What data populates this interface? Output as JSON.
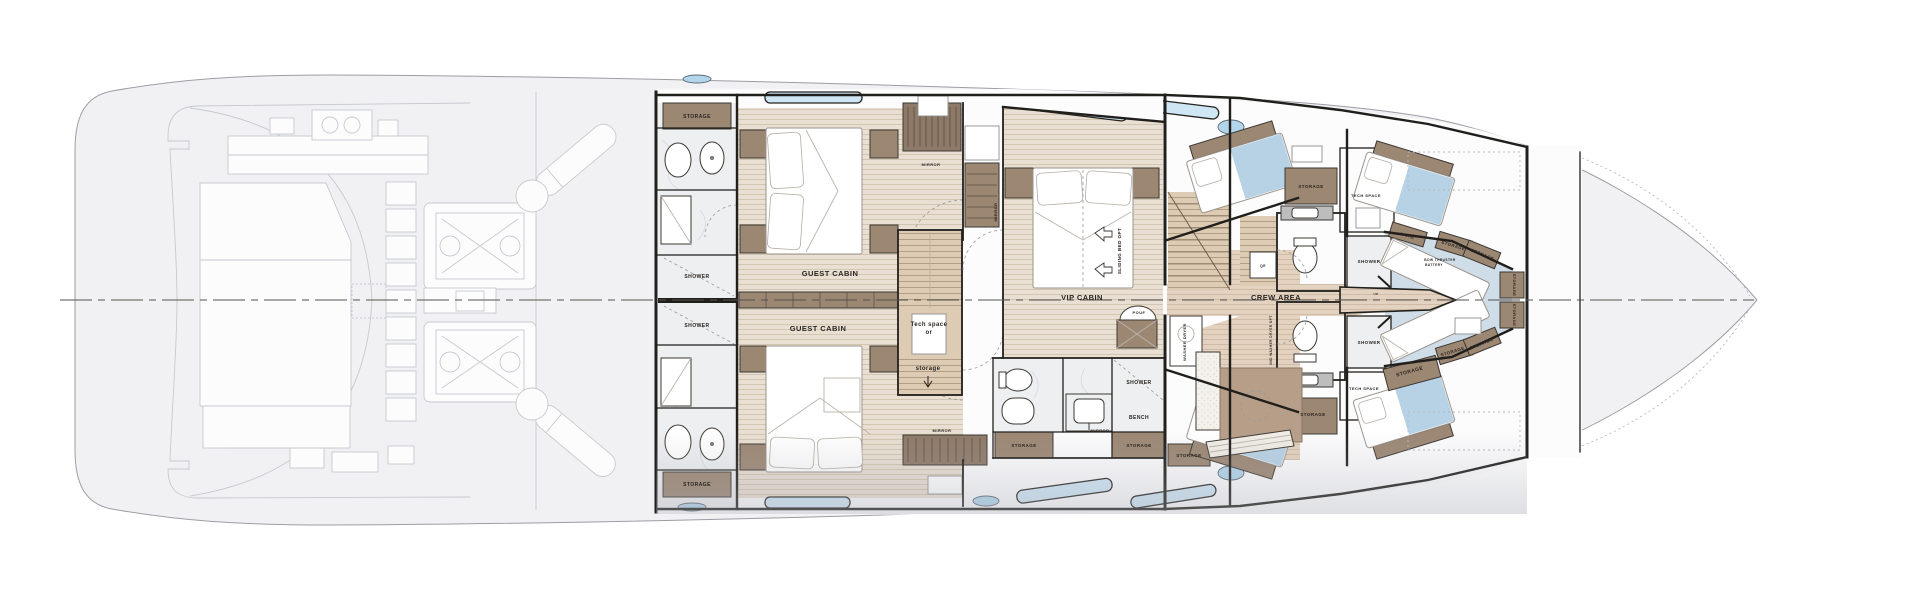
{
  "title": "Yacht lower deck floor plan",
  "colors": {
    "hull": "#f1f1f3",
    "hullStroke": "#9d9da4",
    "faded": "#c7c9cf",
    "wall": "#211f1c",
    "wood": "#e9dfd2",
    "woodLine": "#cdbfa9",
    "crewWood": "#e3d2c0",
    "crewWoodLine": "#c9b29a",
    "marble": "#edeff1",
    "marbleVein": "#d6dade",
    "brown": "#9c8773",
    "hanger": "#8e7a68",
    "blue": "#cfe6f5",
    "bedding": "#b7d2e5",
    "vfloor": "#cfdde9",
    "porthole": "#b2d5ec",
    "stair": "#ddcbb3",
    "counter": "#bdbdbd",
    "speckle": "#f3f1ec",
    "white": "#fcfcfd",
    "shadow": "#a9abb4",
    "text": "#2a2622"
  },
  "labels": [
    {
      "name": "label-storage-aft-bath-top",
      "text": "STORAGE",
      "x": 697,
      "y": 118,
      "size": 5,
      "rot": 0
    },
    {
      "name": "label-shower-guest-top",
      "text": "SHOWER",
      "x": 697,
      "y": 278,
      "size": 5,
      "rot": 0
    },
    {
      "name": "label-shower-guest-bottom",
      "text": "SHOWER",
      "x": 697,
      "y": 327,
      "size": 5,
      "rot": 0
    },
    {
      "name": "label-storage-aft-bath-bottom",
      "text": "STORAGE",
      "x": 697,
      "y": 486,
      "size": 5,
      "rot": 0
    },
    {
      "name": "label-guest-cabin-top",
      "text": "GUEST CABIN",
      "x": 830,
      "y": 276,
      "size": 7.5,
      "rot": 0
    },
    {
      "name": "label-guest-cabin-bottom",
      "text": "GUEST CABIN",
      "x": 818,
      "y": 331,
      "size": 7.5,
      "rot": 0
    },
    {
      "name": "label-tech-space-line1",
      "text": "Tech space",
      "x": 929,
      "y": 326,
      "size": 6,
      "rot": 0
    },
    {
      "name": "label-tech-space-line2",
      "text": "or",
      "x": 929,
      "y": 334,
      "size": 6,
      "rot": 0
    },
    {
      "name": "label-tech-space-line3",
      "text": "storage",
      "x": 928,
      "y": 370,
      "size": 6,
      "rot": 0
    },
    {
      "name": "label-mirror-guest-top",
      "text": "MIRROR",
      "x": 931,
      "y": 166,
      "size": 4,
      "rot": 0
    },
    {
      "name": "label-mirror-guest-bottom",
      "text": "MIRROR",
      "x": 942,
      "y": 432,
      "size": 4,
      "rot": 0
    },
    {
      "name": "label-mirror-vip-entry",
      "text": "MIRROR",
      "x": 997,
      "y": 212,
      "size": 4,
      "rot": -90
    },
    {
      "name": "label-vip-cabin",
      "text": "VIP CABIN",
      "x": 1082,
      "y": 300,
      "size": 7.5,
      "rot": 0
    },
    {
      "name": "label-sliding-bed-opt",
      "text": "SLIDING BED OPT",
      "x": 1121,
      "y": 251,
      "size": 4.5,
      "rot": -90
    },
    {
      "name": "label-pouf",
      "text": "POUF",
      "x": 1139,
      "y": 314,
      "size": 4,
      "rot": 0
    },
    {
      "name": "label-mirror-vip",
      "text": "MIRROR",
      "x": 1100,
      "y": 432,
      "size": 4,
      "rot": 0
    },
    {
      "name": "label-shower-vip",
      "text": "SHOWER",
      "x": 1139,
      "y": 384,
      "size": 5,
      "rot": 0
    },
    {
      "name": "label-bench-vip",
      "text": "BENCH",
      "x": 1139,
      "y": 419,
      "size": 5,
      "rot": 0
    },
    {
      "name": "label-storage-vip-left",
      "text": "STORAGE",
      "x": 1024,
      "y": 447,
      "size": 4.5,
      "rot": 0
    },
    {
      "name": "label-storage-vip-right",
      "text": "STORAGE",
      "x": 1139,
      "y": 447,
      "size": 4.5,
      "rot": 0
    },
    {
      "name": "label-washer-dryer",
      "text": "WASHER DRYER",
      "x": 1186,
      "y": 342,
      "size": 4,
      "rot": -90
    },
    {
      "name": "label-crew-area",
      "text": "CREW AREA",
      "x": 1276,
      "y": 300,
      "size": 7.5,
      "rot": 0
    },
    {
      "name": "label-storage-crew-top",
      "text": "STORAGE",
      "x": 1311,
      "y": 188,
      "size": 4.5,
      "rot": 0
    },
    {
      "name": "label-tech-space-top",
      "text": "TECH SPACE",
      "x": 1366,
      "y": 197,
      "size": 4,
      "rot": 0
    },
    {
      "name": "label-shower-crew-top",
      "text": "SHOWER",
      "x": 1369,
      "y": 263,
      "size": 4.5,
      "rot": 0
    },
    {
      "name": "label-shower-crew-bottom",
      "text": "SHOWER",
      "x": 1369,
      "y": 344,
      "size": 4.5,
      "rot": 0
    },
    {
      "name": "label-tech-space-bottom",
      "text": "TECH SPACE",
      "x": 1364,
      "y": 390,
      "size": 4,
      "rot": 0
    },
    {
      "name": "label-storage-crew-bottom",
      "text": "STORAGE",
      "x": 1313,
      "y": 416,
      "size": 4.5,
      "rot": 0
    },
    {
      "name": "label-storage-crew-mess",
      "text": "STORAGE",
      "x": 1189,
      "y": 457,
      "size": 4.5,
      "rot": 0
    },
    {
      "name": "label-qe",
      "text": "QE",
      "x": 1263,
      "y": 267,
      "size": 3.5,
      "rot": 0
    },
    {
      "name": "label-2nd-washer-opt",
      "text": "2ND WASHER DRYER OPT",
      "x": 1272,
      "y": 340,
      "size": 3.2,
      "rot": -90
    },
    {
      "name": "label-up",
      "text": "UP",
      "x": 1376,
      "y": 295,
      "size": 3,
      "rot": 0
    },
    {
      "name": "label-niche",
      "text": "NICHE",
      "x": 1407,
      "y": 237,
      "size": 4,
      "rot": 17
    },
    {
      "name": "label-storage-bow-1",
      "text": "STORAGE",
      "x": 1453,
      "y": 247,
      "size": 4.4,
      "rot": 17
    },
    {
      "name": "label-storage-bow-2",
      "text": "STORAGE",
      "x": 1482,
      "y": 256,
      "size": 4.4,
      "rot": 22
    },
    {
      "name": "label-storage-bow-3",
      "text": "STORAGE",
      "x": 1513,
      "y": 285,
      "size": 4,
      "rot": 90
    },
    {
      "name": "label-storage-bow-4",
      "text": "STORAGE",
      "x": 1513,
      "y": 315,
      "size": 4,
      "rot": 90
    },
    {
      "name": "label-storage-bow-5",
      "text": "STORAGE",
      "x": 1453,
      "y": 353,
      "size": 4.4,
      "rot": -17
    },
    {
      "name": "label-storage-bow-6",
      "text": "STORAGE",
      "x": 1482,
      "y": 345,
      "size": 4.4,
      "rot": -22
    },
    {
      "name": "label-storage-bow-big",
      "text": "STORAGE",
      "x": 1410,
      "y": 373,
      "size": 5,
      "rot": -15
    },
    {
      "name": "label-bow-thruster-1",
      "text": "BOW THRUSTER",
      "x": 1440,
      "y": 261,
      "size": 3.2,
      "rot": 0
    },
    {
      "name": "label-bow-thruster-2",
      "text": "BATTERY",
      "x": 1434,
      "y": 266,
      "size": 3.2,
      "rot": 0
    }
  ]
}
